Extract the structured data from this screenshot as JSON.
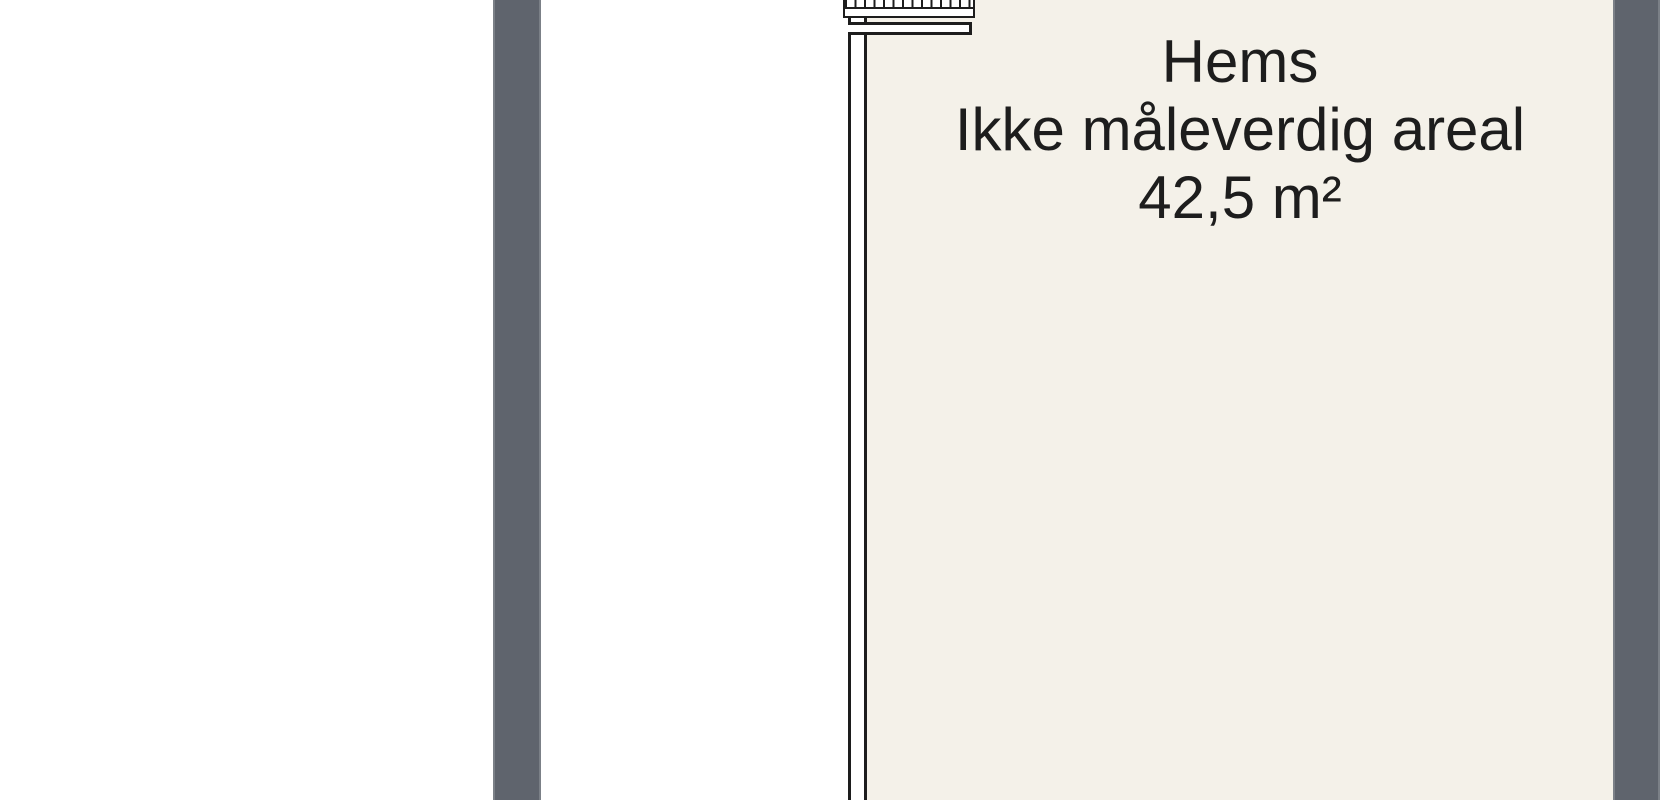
{
  "floorplan": {
    "room": {
      "name": "Hems",
      "note": "Ikke måleverdig areal",
      "area": "42,5 m²"
    },
    "colors": {
      "background": "#ffffff",
      "room_fill": "#f4f1e9",
      "wall_gray": "#5f646d",
      "line": "#1d1d1d"
    }
  }
}
